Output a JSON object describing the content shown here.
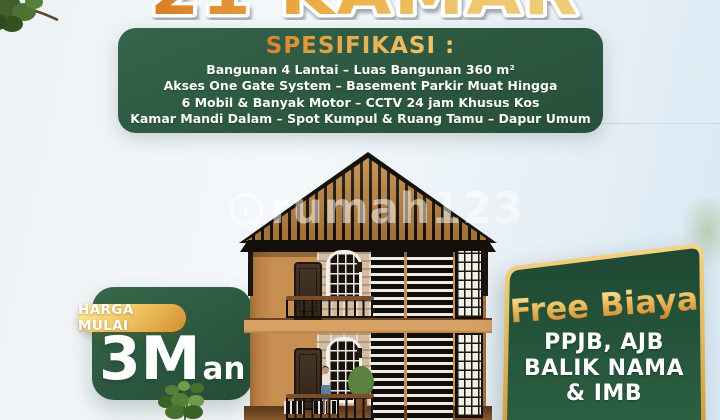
{
  "headline": {
    "text": "21 KAMAR"
  },
  "spec_box": {
    "heading": "SPESIFIKASI :",
    "lines": [
      "Bangunan 4 Lantai – Luas Bangunan 360 m²",
      "Akses One Gate System – Basement Parkir Muat Hingga",
      "6 Mobil & Banyak Motor – CCTV 24 jam Khusus Kos",
      "Kamar Mandi Dalam – Spot Kumpul & Ruang Tamu – Dapur Umum"
    ]
  },
  "price_box": {
    "badge": "HARGA MULAI",
    "amount": "3M",
    "suffix": "an"
  },
  "promo_box": {
    "heading": "Free Biaya",
    "lines": [
      "PPJB, AJB",
      "BALIK NAMA",
      "& IMB"
    ]
  },
  "watermark": {
    "logo": "r",
    "text": "rumah123"
  },
  "colors": {
    "panel_green": "#2e5a43",
    "gold_accent": "#e8b54a",
    "wall_orange": "#c2854a",
    "sky_blue": "#e4eef6"
  }
}
